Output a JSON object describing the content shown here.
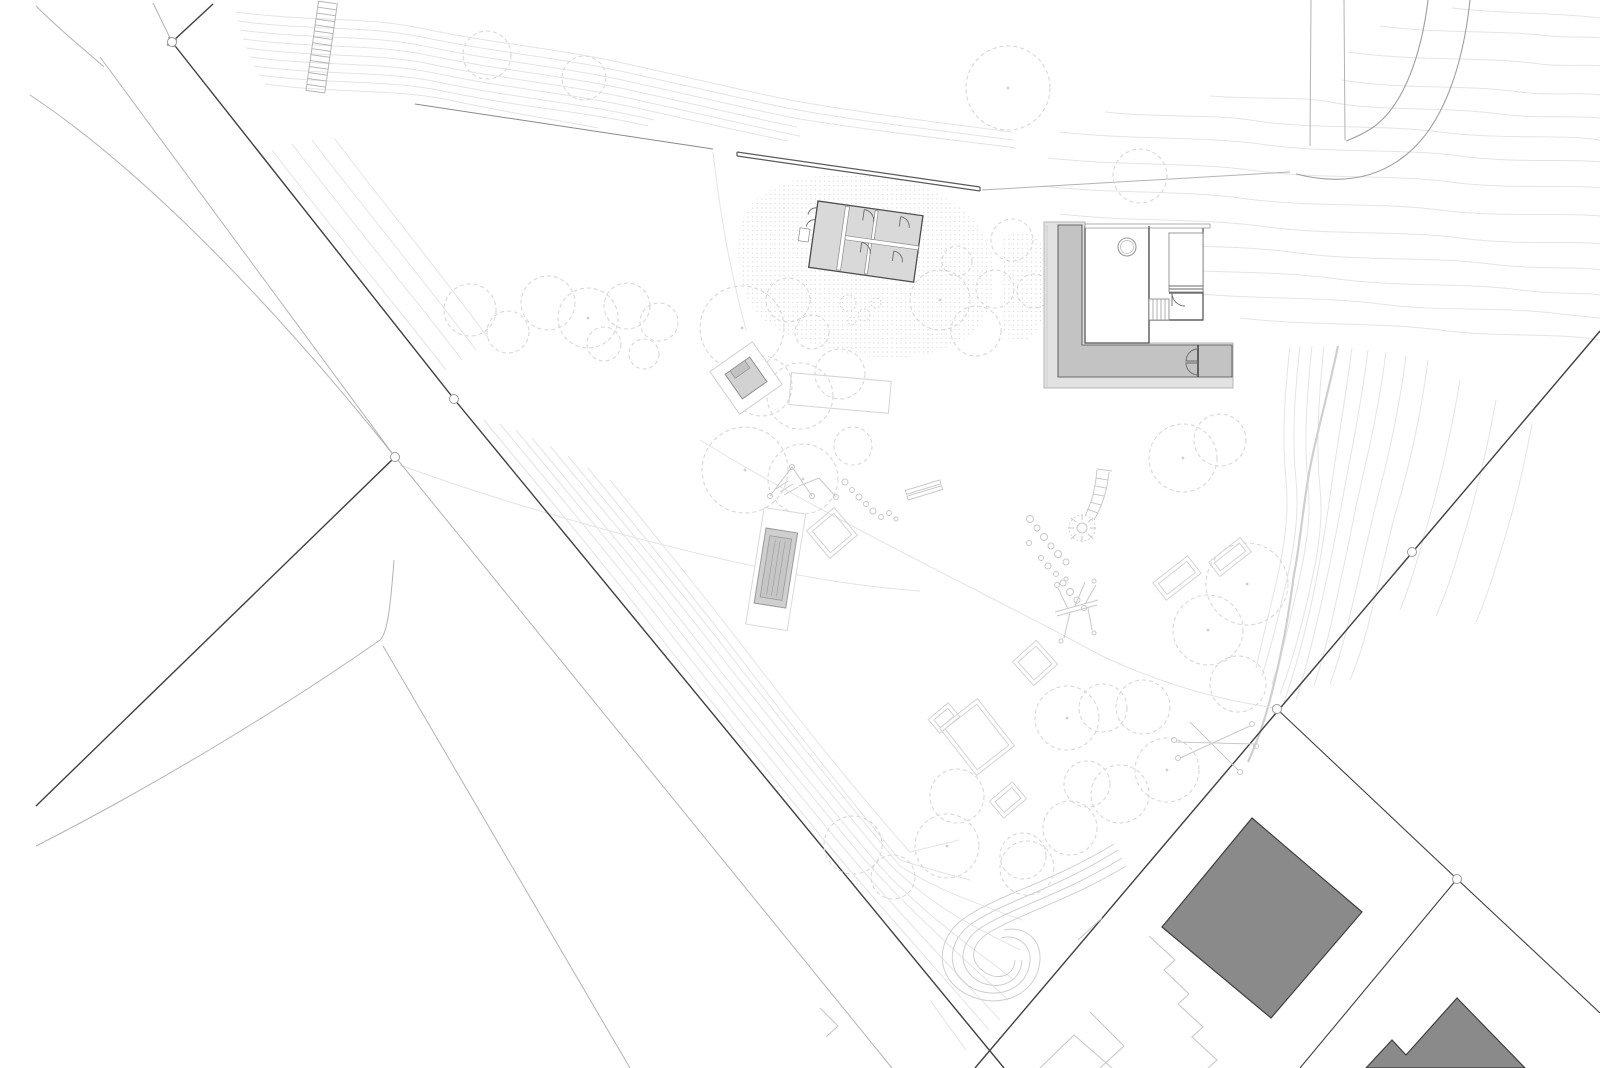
{
  "document": {
    "kind": "architectural-site-plan",
    "visible_text": "",
    "notes_on_screen": ""
  },
  "colors": {
    "background": "#ffffff",
    "contour": "#e4e4e4",
    "contour_strong": "#cfcfcf",
    "tree_outline": "#d8d8d8",
    "road_edge": "#b3b3b3",
    "boundary": "#3f3f3f",
    "wall": "#5a5a5a",
    "building_light_fill": "#d9d9d9",
    "building_band_fill": "#c3c3c3",
    "building_roof_fill": "#e2e2e2",
    "building_outline": "#4d4d4d",
    "neighbor_building_fill": "#8a8a8a",
    "neighbor_building_outline": "#3f3f3f",
    "play_equipment": "#c9c9c9",
    "stipple_dot": "#d9d9d9",
    "marker": "#9a9a9a"
  },
  "features": {
    "contours": "terrain contour lines",
    "boundaries": "property boundary lines with survey markers",
    "streets": "street edge lines",
    "retaining_wall": "long retaining wall",
    "garden_stairs": "outdoor stair on slope",
    "pavilion_building": "small pavilion with four rooms",
    "l_building": "L-shaped building with court",
    "neighbor_buildings": "dark neighbouring buildings",
    "playground": "play equipment, rocks, slide, sandbox",
    "trees": "dashed tree canopies"
  }
}
